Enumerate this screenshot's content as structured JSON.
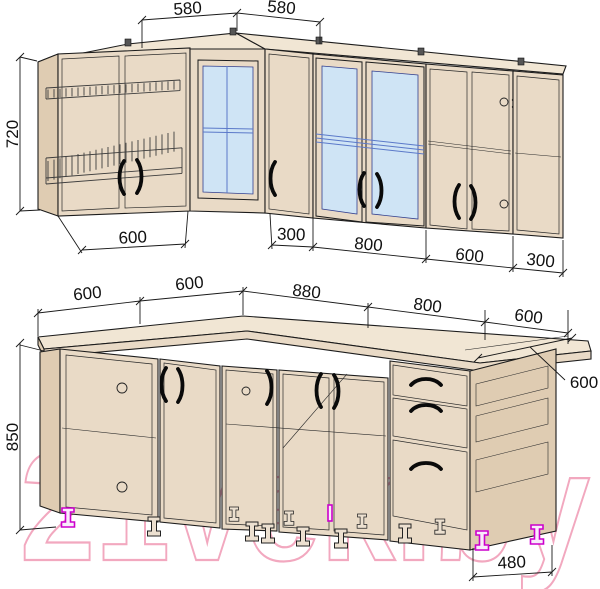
{
  "watermark": {
    "text": "21vek.by"
  },
  "upper": {
    "top_dims": [
      "580",
      "580"
    ],
    "height_dim": "720",
    "bottom_dims": [
      "600",
      "300",
      "800",
      "600",
      "300"
    ]
  },
  "lower": {
    "top_dims": [
      "600",
      "600",
      "880",
      "800",
      "600"
    ],
    "depth_dim": "600",
    "height_dim": "850",
    "bottom_dim": "480"
  },
  "colors": {
    "cabinet_face": "#e9dac6",
    "cabinet_top": "#f1e6d4",
    "glass": "#cfe4f5",
    "outline": "#1c1c1c",
    "feet_accent": "#cc00cc",
    "watermark": "#f2a8bf"
  }
}
